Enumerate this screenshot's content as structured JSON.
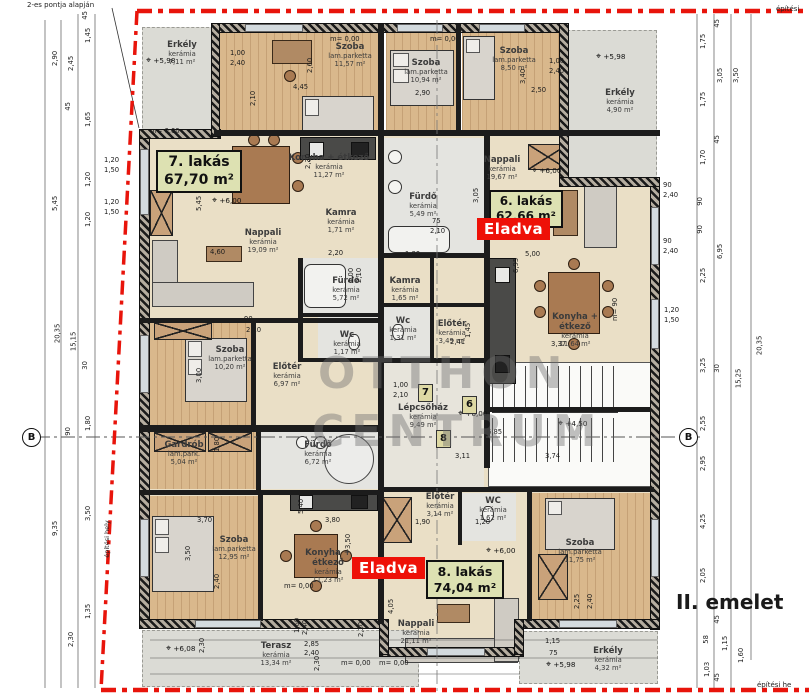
{
  "title": {
    "floor": "II. emelet",
    "watermark_top": "OTTHON",
    "watermark_bottom": "CENTRUM",
    "note_top_left": "2-es pontja alapján",
    "build_area_left": "építési hely",
    "build_area_top_right": "építési",
    "build_area_bottom_right": "építési he",
    "section": "B"
  },
  "apartments": {
    "a7": {
      "name": "7. lakás",
      "area": "67,70 m²"
    },
    "a6": {
      "name": "6. lakás",
      "area": "62,66 m²"
    },
    "a8": {
      "name": "8. lakás",
      "area": "74,04 m²"
    },
    "sold": "Eladva"
  },
  "door_numbers": {
    "d7": "7",
    "d6": "6",
    "d8": "8"
  },
  "rooms": [
    {
      "name": "Erkély",
      "material": "kerámia",
      "area": "7,11 m²"
    },
    {
      "name": "Szoba",
      "material": "lam.parketta",
      "area": "11,57 m²"
    },
    {
      "name": "Szoba",
      "material": "lam.parketta",
      "area": "10,94 m²"
    },
    {
      "name": "Szoba",
      "material": "lam.parketta",
      "area": "8,50 m²"
    },
    {
      "name": "Erkély",
      "material": "kerámia",
      "area": "4,90 m²"
    },
    {
      "name": "Konyha + étkező",
      "material": "kerámia",
      "area": "11,27 m²"
    },
    {
      "name": "Kamra",
      "material": "kerámia",
      "area": "1,71 m²"
    },
    {
      "name": "Nappali",
      "material": "kerámia",
      "area": "19,09 m²"
    },
    {
      "name": "Fürdő",
      "material": "kerámia",
      "area": "5,72 m²"
    },
    {
      "name": "Wc",
      "material": "kerámia",
      "area": "1,17 m²"
    },
    {
      "name": "Előtér",
      "material": "kerámia",
      "area": "6,97 m²"
    },
    {
      "name": "Szoba",
      "material": "lam.parketta",
      "area": "10,20 m²"
    },
    {
      "name": "Nappali",
      "material": "kerámia",
      "area": "19,67 m²"
    },
    {
      "name": "Fürdő",
      "material": "kerámia",
      "area": "5,49 m²"
    },
    {
      "name": "Kamra",
      "material": "kerámia",
      "area": "1,65 m²"
    },
    {
      "name": "Wc",
      "material": "kerámia",
      "area": "1,31 m²"
    },
    {
      "name": "Előtér",
      "material": "kerámia",
      "area": "3,49 m²"
    },
    {
      "name": "Konyha + étkező",
      "material": "kerámia",
      "area": "11,64 m²"
    },
    {
      "name": "Lépcsőház",
      "material": "kerámia",
      "area": "9,49 m²"
    },
    {
      "name": "Gardrób",
      "material": "lam.park.",
      "area": "5,04 m²"
    },
    {
      "name": "Fürdő",
      "material": "kerámia",
      "area": "6,72 m²"
    },
    {
      "name": "Előtér",
      "material": "kerámia",
      "area": "3,14 m²"
    },
    {
      "name": "WC",
      "material": "kerámia",
      "area": "1,62 m²"
    },
    {
      "name": "Szoba",
      "material": "lam.parketta",
      "area": "12,95 m²"
    },
    {
      "name": "Konyha + étkező",
      "material": "kerámia",
      "area": "11,23 m²"
    },
    {
      "name": "Nappali",
      "material": "kerámia",
      "area": "21,11 m²"
    },
    {
      "name": "Szoba",
      "material": "lam.parketta",
      "area": "11,75 m²"
    },
    {
      "name": "Terasz",
      "material": "kerámia",
      "area": "13,34 m²"
    },
    {
      "name": "Erkély",
      "material": "kerámia",
      "area": "4,32 m²"
    }
  ],
  "levels": {
    "tl": "+5,98",
    "tr": "+5,98",
    "n7": "+6,00",
    "n6": "+6,00",
    "stair": "+6,00",
    "half": "+4,50",
    "terasz": "+6,08",
    "n8": "+6,00",
    "br": "+5,98"
  },
  "misc": {
    "m000": "m= 0,00",
    "m90": "m= 90",
    "level_symbol": "⌖"
  },
  "dims_left": [
    "45",
    "2,90",
    "2,45",
    "1,45",
    "1,65",
    "45",
    "1,20",
    "1,50",
    "1,20",
    "1,20",
    "1,50",
    "1,20",
    "5,45",
    "20,35",
    "15,15",
    "30",
    "1,80",
    "90",
    "3,50",
    "9,35",
    "1,35",
    "2,30"
  ],
  "dims_right": [
    "45",
    "1,75",
    "3,05",
    "3,50",
    "1,75",
    "45",
    "1,70",
    "90",
    "90",
    "6,95",
    "2,25",
    "3,25",
    "30",
    "15,25",
    "20,35",
    "2,55",
    "2,95",
    "4,25",
    "2,05",
    "45",
    "1,15",
    "58",
    "1,60",
    "1,03",
    "45",
    "90",
    "2,40",
    "90",
    "2,40",
    "1,20",
    "1,50",
    "2,25",
    "2,40"
  ],
  "dims_bottom": [
    "2,30",
    "1,60",
    "2,40",
    "2,85",
    "2,40",
    "2,30",
    "4,05",
    "2,30",
    "1,15",
    "75"
  ],
  "dims_inner": [
    "4,45",
    "2,60",
    "2,10",
    "1,00",
    "2,40",
    "2,90",
    "3,40",
    "2,50",
    "1,00",
    "2,40",
    "5,45",
    "4,60",
    "3,05",
    "5,00",
    "6,95",
    "3,37",
    "2,20",
    "1,80",
    "3,11",
    "3,74",
    "6,85",
    "3,70",
    "3,50",
    "2,40",
    "3,80",
    "3,50",
    "5,40",
    "1,90",
    "1,20",
    "1,45",
    "2,41",
    "2,30",
    "3,00",
    "1,80",
    "75",
    "2,10",
    "90",
    "2,10",
    "1,00",
    "2,10",
    "1,00",
    "2,10"
  ]
}
